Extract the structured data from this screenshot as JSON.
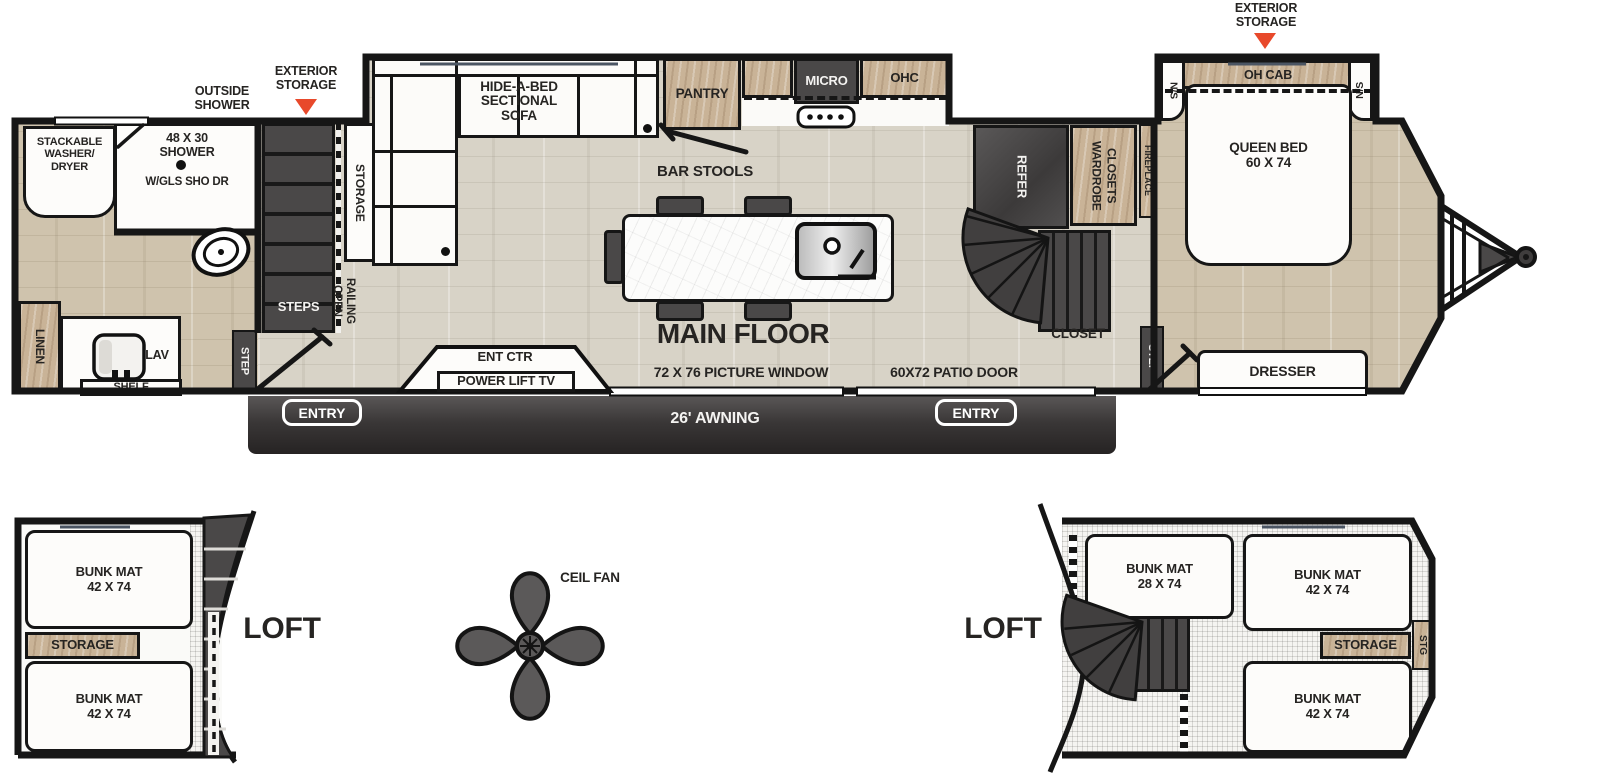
{
  "colors": {
    "accent_red": "#e8492b",
    "wall": "#161616",
    "floor_main": "#d8d3c7",
    "floor_warm": "#cfc3ad",
    "cabinet_wood": "#c9b397",
    "fixture_dark": "#4a4848",
    "text": "#262422"
  },
  "callouts": {
    "outside_shower": "OUTSIDE\nSHOWER",
    "exterior_storage_mid": "EXTERIOR\nSTORAGE",
    "exterior_storage_front": "EXTERIOR\nSTORAGE"
  },
  "bath": {
    "washer_dryer": "STACKABLE\nWASHER/\nDRYER",
    "shower": "48 X 30\nSHOWER",
    "shower_door": "W/GLS SHO DR",
    "linen": "LINEN",
    "lav": "LAV",
    "shelf": "SHELF",
    "step": "STEP"
  },
  "stairwell": {
    "steps": "STEPS",
    "storage": "STORAGE",
    "open_railing": "OPEN\nRAILING"
  },
  "living": {
    "sofa": "HIDE-A-BED\nSECTIONAL\nSOFA",
    "bar_stools": "BAR STOOLS",
    "main_floor": "MAIN FLOOR",
    "picture_window": "72 X 76 PICTURE WINDOW",
    "ent_ctr": "ENT CTR",
    "power_lift_tv": "POWER LIFT TV",
    "awning": "26' AWNING",
    "entry_left": "ENTRY",
    "entry_right": "ENTRY"
  },
  "kitchen": {
    "pantry": "PANTRY",
    "micro": "MICRO",
    "ohc": "OHC",
    "patio_door": "60X72 PATIO DOOR"
  },
  "hall": {
    "refer": "REFER",
    "wardrobe": "WARDROBE\nCLOSETS",
    "fireplace": "FIREPLACE",
    "closet": "CLOSET",
    "step": "STEP"
  },
  "bedroom": {
    "oh_cab": "OH CAB",
    "ns_left": "N/S",
    "ns_right": "N/S",
    "queen_bed": "QUEEN BED\n60 X 74",
    "dresser": "DRESSER"
  },
  "lofts": {
    "left": {
      "title": "LOFT",
      "bunk_top": "BUNK MAT\n42 X 74",
      "storage": "STORAGE",
      "bunk_bottom": "BUNK MAT\n42 X 74"
    },
    "right": {
      "title": "LOFT",
      "bunk_small": "BUNK MAT\n28 X 74",
      "bunk_top": "BUNK MAT\n42 X 74",
      "storage": "STORAGE",
      "stg": "STG",
      "bunk_bottom": "BUNK MAT\n42 X 74"
    },
    "ceiling_fan": "CEIL FAN"
  }
}
